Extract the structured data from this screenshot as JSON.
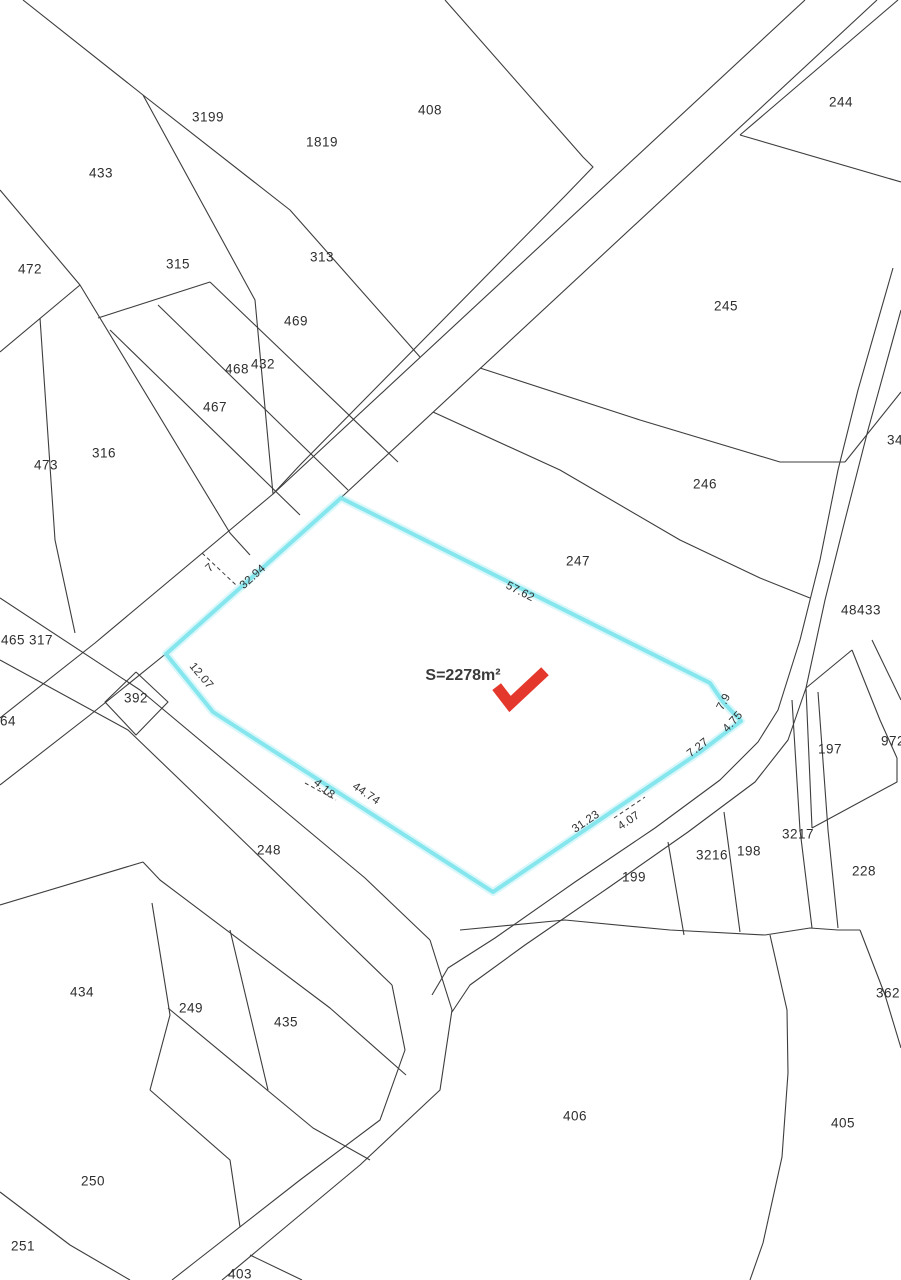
{
  "map": {
    "background": "#ffffff",
    "line_color": "#3d3d3d",
    "highlight": {
      "parcel_id": "272",
      "area_label": "S=2278m²",
      "stroke_color": "#85e6ee",
      "area_label_x": 463,
      "area_label_y": 676,
      "parcel_id_x": 480,
      "parcel_id_y": 707,
      "polygon": "341,498 710,683 723,702 741,721 700,752 493,892 213,712 166,654"
    },
    "arrow": {
      "name": "red-check-arrow",
      "color": "#e4382c",
      "path": "M500,691 L510,704 L541,675"
    },
    "parcel_labels": [
      {
        "t": "3199",
        "x": 208,
        "y": 117
      },
      {
        "t": "433",
        "x": 101,
        "y": 173
      },
      {
        "t": "1819",
        "x": 322,
        "y": 142
      },
      {
        "t": "408",
        "x": 430,
        "y": 110
      },
      {
        "t": "244",
        "x": 841,
        "y": 102
      },
      {
        "t": "472",
        "x": 30,
        "y": 269
      },
      {
        "t": "315",
        "x": 178,
        "y": 264
      },
      {
        "t": "313",
        "x": 322,
        "y": 257
      },
      {
        "t": "469",
        "x": 296,
        "y": 321
      },
      {
        "t": "432",
        "x": 263,
        "y": 364
      },
      {
        "t": "468",
        "x": 237,
        "y": 369
      },
      {
        "t": "467",
        "x": 215,
        "y": 407
      },
      {
        "t": "316",
        "x": 104,
        "y": 453
      },
      {
        "t": "473",
        "x": 46,
        "y": 465
      },
      {
        "t": "245",
        "x": 726,
        "y": 306
      },
      {
        "t": "246",
        "x": 705,
        "y": 484
      },
      {
        "t": "247",
        "x": 578,
        "y": 561
      },
      {
        "t": "34",
        "x": 895,
        "y": 440
      },
      {
        "t": "48433",
        "x": 861,
        "y": 610
      },
      {
        "t": "465",
        "x": 13,
        "y": 640
      },
      {
        "t": "317",
        "x": 41,
        "y": 640
      },
      {
        "t": "392",
        "x": 136,
        "y": 698
      },
      {
        "t": "464",
        "x": 4,
        "y": 721
      },
      {
        "t": "197",
        "x": 830,
        "y": 749
      },
      {
        "t": "972",
        "x": 893,
        "y": 741
      },
      {
        "t": "3216",
        "x": 712,
        "y": 855
      },
      {
        "t": "198",
        "x": 749,
        "y": 851
      },
      {
        "t": "3217",
        "x": 798,
        "y": 834
      },
      {
        "t": "228",
        "x": 864,
        "y": 871
      },
      {
        "t": "199",
        "x": 634,
        "y": 877
      },
      {
        "t": "248",
        "x": 269,
        "y": 850
      },
      {
        "t": "434",
        "x": 82,
        "y": 992
      },
      {
        "t": "249",
        "x": 191,
        "y": 1008
      },
      {
        "t": "435",
        "x": 286,
        "y": 1022
      },
      {
        "t": "250",
        "x": 93,
        "y": 1181
      },
      {
        "t": "406",
        "x": 575,
        "y": 1116
      },
      {
        "t": "405",
        "x": 843,
        "y": 1123
      },
      {
        "t": "362",
        "x": 888,
        "y": 993
      },
      {
        "t": "251",
        "x": 23,
        "y": 1246
      },
      {
        "t": "403",
        "x": 240,
        "y": 1274
      }
    ],
    "dimension_labels": [
      {
        "t": "7",
        "x": 210,
        "y": 568,
        "r": -42
      },
      {
        "t": "32.94",
        "x": 253,
        "y": 577,
        "r": -42
      },
      {
        "t": "57.62",
        "x": 520,
        "y": 592,
        "r": 27
      },
      {
        "t": "12.07",
        "x": 201,
        "y": 676,
        "r": 50
      },
      {
        "t": "4.18",
        "x": 324,
        "y": 789,
        "r": 40
      },
      {
        "t": "44.74",
        "x": 366,
        "y": 794,
        "r": 34
      },
      {
        "t": "31.23",
        "x": 586,
        "y": 822,
        "r": -34
      },
      {
        "t": "4.07",
        "x": 629,
        "y": 821,
        "r": -34
      },
      {
        "t": "7.27",
        "x": 698,
        "y": 748,
        "r": -38
      },
      {
        "t": "4.75",
        "x": 733,
        "y": 722,
        "r": -48
      },
      {
        "t": "7.9",
        "x": 724,
        "y": 702,
        "r": -62
      }
    ],
    "geometry": {
      "boundaries": [
        "23,0 143,95",
        "143,95 255,300 273,494",
        "143,95 290,210 420,357",
        "805,0 273,494 95,643 0,718",
        "877,0 345,494 168,652 90,715 0,785",
        "445,0 583,157 593,167 565,196 300,465 273,494",
        "740,135 901,182",
        "898,0 740,135",
        "901,392 845,462",
        "480,368 640,420 780,462 845,462",
        "433,412 560,470 680,540 760,578 810,598",
        "893,268 858,390 838,470 820,560 800,640 778,710 758,742 720,780 655,828 575,882 495,938 448,968 432,995",
        "901,310 868,430 845,520 825,600 806,688 788,740 755,782 688,832 608,888 525,945 470,985 452,1012",
        "0,598 140,690 250,782 365,878 430,940",
        "0,660 128,730 232,830 330,925 392,985",
        "392,985 405,1050 380,1120 300,1180 195,1262 172,1280",
        "430,940 452,1010 440,1090 360,1165 270,1240 222,1280",
        "250,1255 302,1280",
        "110,330 300,515",
        "158,305 348,490",
        "210,282 398,462",
        "98,318 210,282",
        "0,190 80,285",
        "80,285 0,352",
        "80,285 230,533 250,555",
        "40,318 55,540 75,633",
        "136,672 168,702 136,735 105,702 136,672",
        "0,905 143,862",
        "143,862 160,880 330,1008 406,1075",
        "168,1008 313,1128 370,1160",
        "152,903 170,1015 150,1090",
        "230,930 268,1090",
        "0,1192 70,1245 130,1280",
        "150,1090 230,1160 240,1227",
        "460,930 565,920 670,930 765,935",
        "668,842 684,935",
        "724,812 740,932",
        "806,688 852,650",
        "852,650 880,720 897,758",
        "872,640 901,700",
        "897,758 897,782 812,828",
        "812,828 806,688",
        "792,700 800,830 812,928",
        "818,692 828,830 838,928",
        "765,935 810,928 838,930 860,930",
        "860,930 885,995 901,1048",
        "770,935 787,1010 788,1073 782,1157 763,1243 750,1280"
      ],
      "dashed_ticks": [
        "202,553 236,585",
        "305,783 336,800",
        "614,818 645,797"
      ]
    }
  }
}
